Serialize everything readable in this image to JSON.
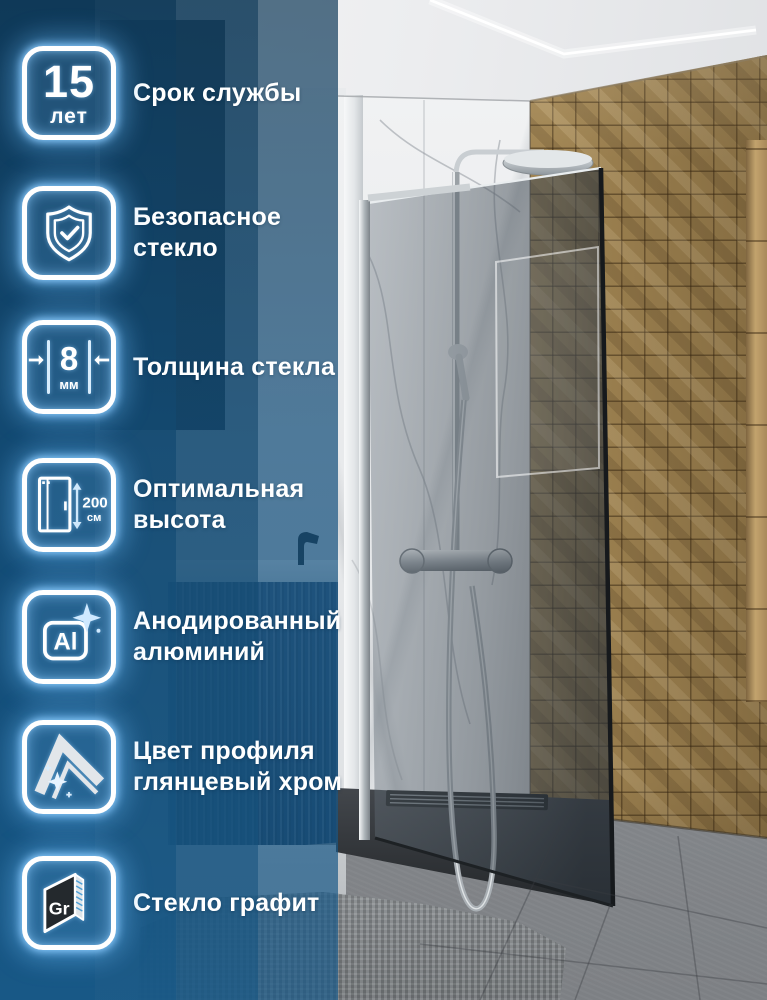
{
  "banner": {
    "features": [
      {
        "label": "Срок службы",
        "badge_value": "15",
        "badge_unit": "лет"
      },
      {
        "label": "Безопасное стекло"
      },
      {
        "label": "Толщина стекла",
        "badge_value": "8",
        "badge_unit": "мм"
      },
      {
        "label": "Оптимальная высота",
        "badge_value": "200",
        "badge_unit": "см"
      },
      {
        "label": "Анодированный алюминий",
        "badge_text": "Al"
      },
      {
        "label": "Цвет профиля глянцевый хром"
      },
      {
        "label": "Стекло графит",
        "badge_text": "Gr"
      }
    ],
    "colors": {
      "overlay_blue": "#14507D",
      "icon_glow": "#8FD2FF",
      "wood_mosaic": "#A08452",
      "graphite_glass": "#2A2E31",
      "chrome": "#C9CED2"
    }
  }
}
